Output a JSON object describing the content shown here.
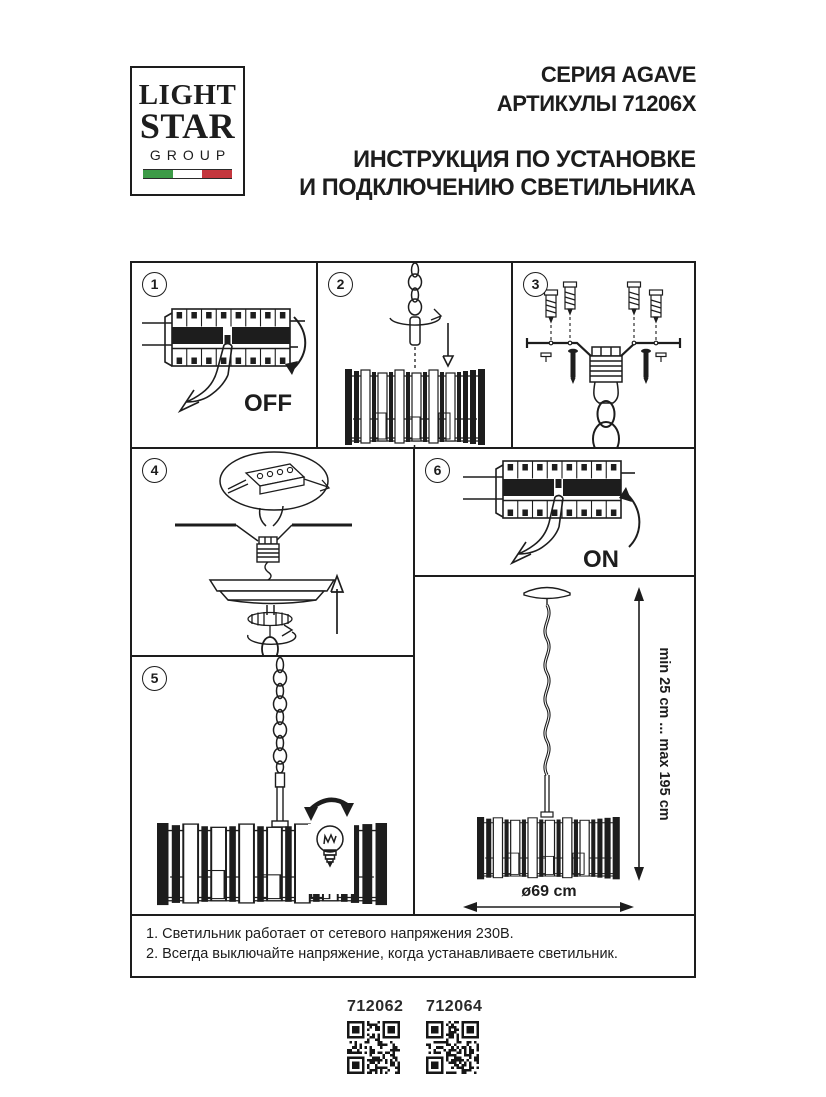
{
  "page": {
    "background": "#ffffff",
    "ink": "#1d1d1d"
  },
  "logo": {
    "line1": "LIGHT",
    "line2": "STAR",
    "line3": "GROUP",
    "flag_colors": [
      "#3d9b47",
      "#ffffff",
      "#c4373e"
    ]
  },
  "header": {
    "series": "СЕРИЯ AGAVE",
    "articles": "АРТИКУЛЫ 71206X",
    "title_line1": "ИНСТРУКЦИЯ ПО УСТАНОВКЕ",
    "title_line2": "И ПОДКЛЮЧЕНИЮ СВЕТИЛЬНИКА"
  },
  "steps": [
    {
      "number": "1",
      "label": "OFF",
      "illustration": "circuit-breaker-switched-off"
    },
    {
      "number": "2",
      "illustration": "chandelier-drum-with-hanging-rod"
    },
    {
      "number": "3",
      "illustration": "ceiling-bracket-with-anchors-and-screws"
    },
    {
      "number": "4",
      "illustration": "terminal-block-wiring-and-canopy-mounting"
    },
    {
      "number": "5",
      "illustration": "hanging-chandelier-bulb-installation"
    },
    {
      "number": "6",
      "label": "ON",
      "illustration": "circuit-breaker-switched-on"
    }
  ],
  "dimensions": {
    "height_range": "min 25 cm ... max 195 cm",
    "diameter": "ø69 cm"
  },
  "notes": [
    "1. Светильник работает от сетевого напряжения 230В.",
    "2. Всегда выключайте напряжение, когда устанавливаете светильник."
  ],
  "footer": {
    "product_codes": [
      "712062",
      "712064"
    ]
  }
}
